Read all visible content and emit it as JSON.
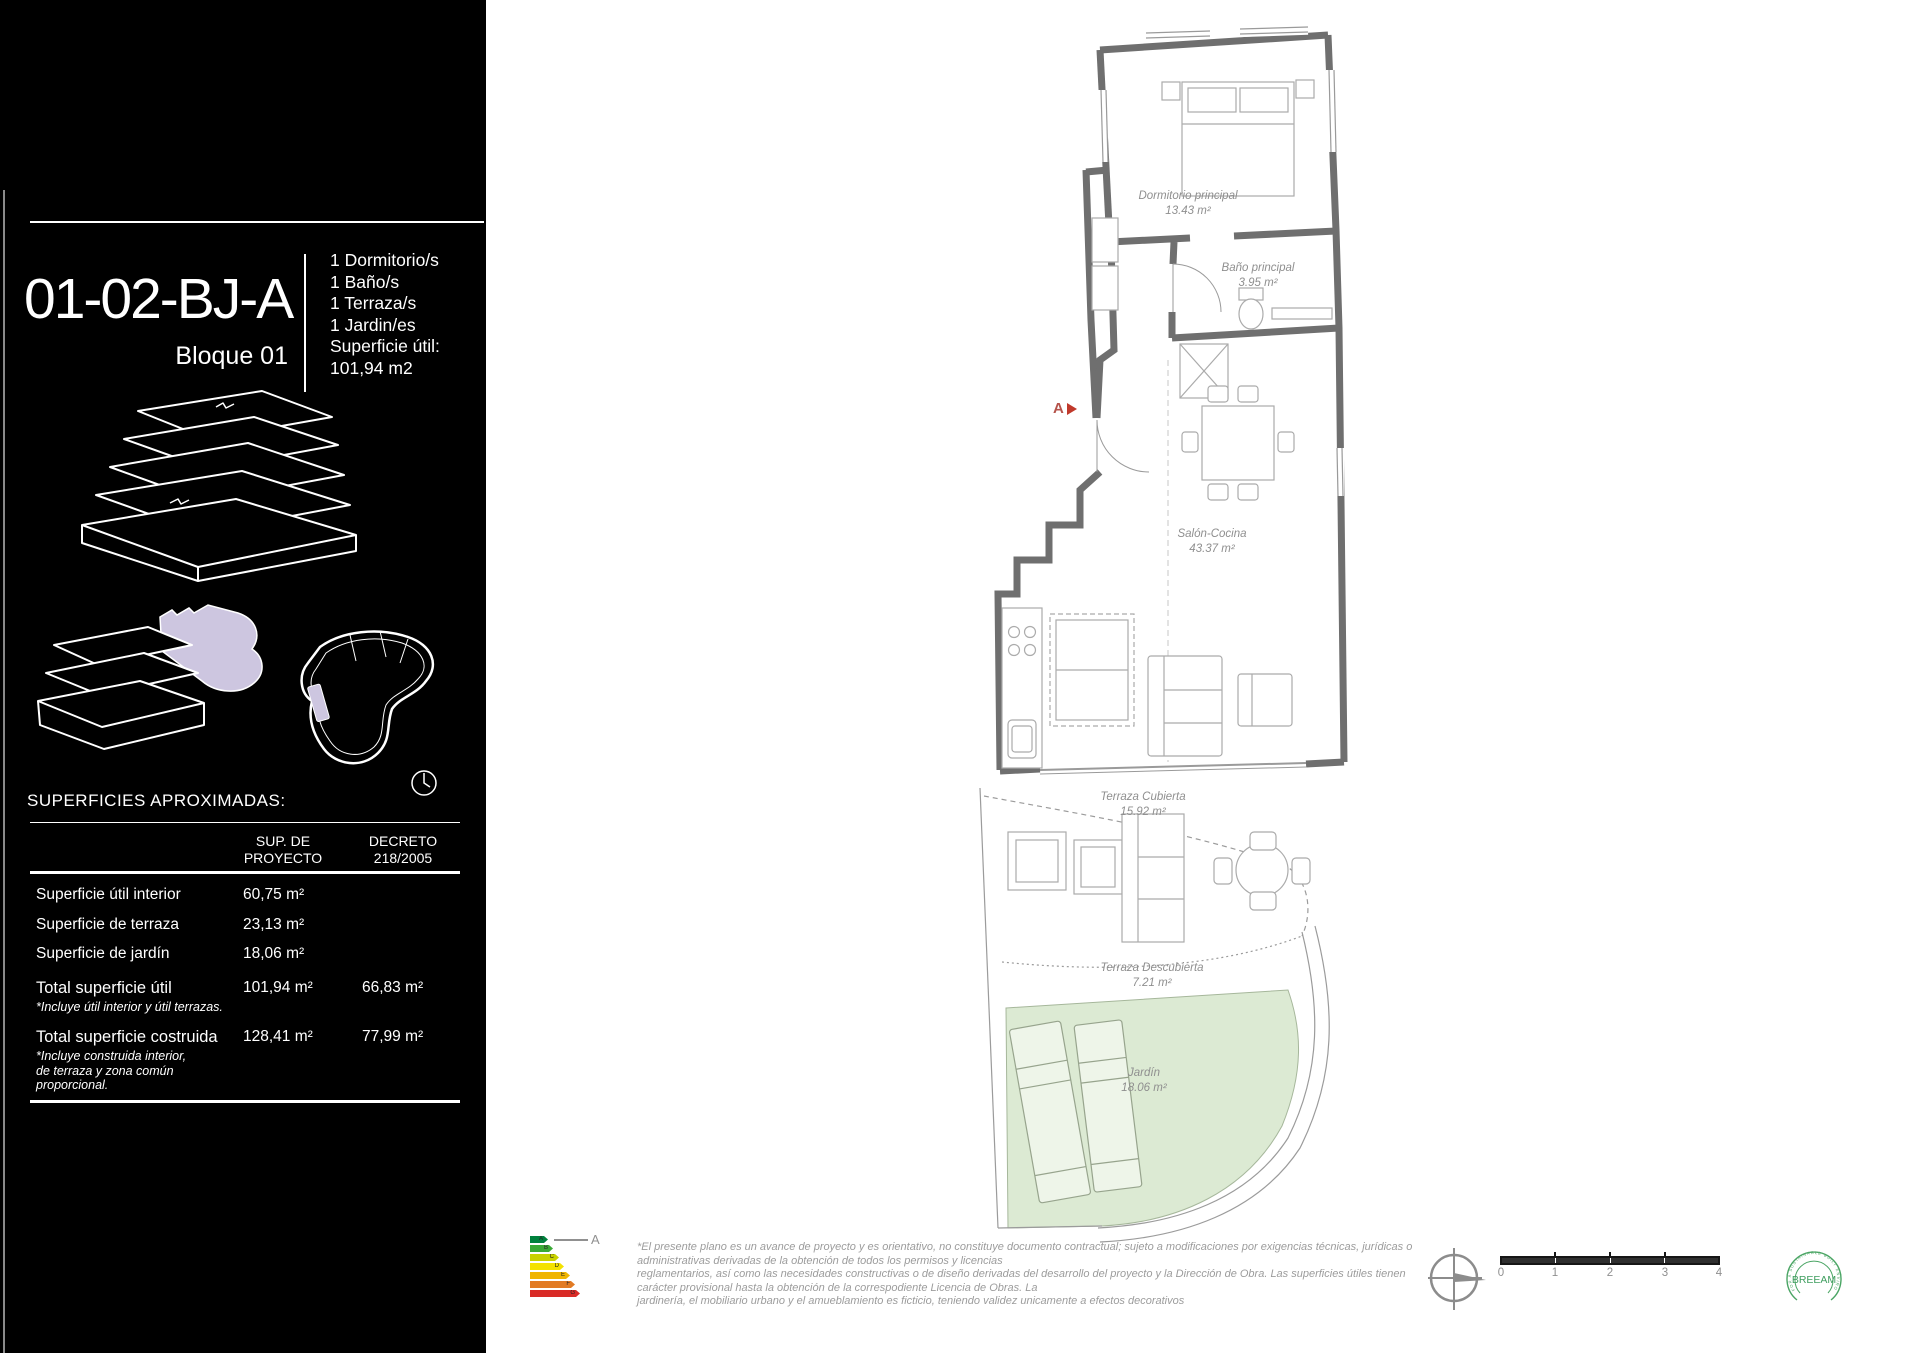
{
  "panel": {
    "unit_code": "01-02-BJ-A",
    "block_label": "Bloque 01",
    "features": [
      "1 Dormitorio/s",
      "1 Baño/s",
      "1 Terraza/s",
      "1 Jardin/es"
    ],
    "superficie_util_label": "Superficie útil:",
    "superficie_util_value": "101,94  m2",
    "surfaces_heading": "SUPERFICIES APROXIMADAS:",
    "table": {
      "col_proyecto": "SUP. DE\nPROYECTO",
      "col_decreto": "DECRETO\n218/2005",
      "rows": [
        {
          "label": "Superficie útil interior",
          "proyecto": "60,75  m²",
          "decreto": ""
        },
        {
          "label": "Superficie de terraza",
          "proyecto": "23,13  m²",
          "decreto": ""
        },
        {
          "label": "Superficie de jardín",
          "proyecto": "18,06 m²",
          "decreto": ""
        }
      ],
      "totals": [
        {
          "label": "Total superficie útil",
          "note": "*Incluye útil interior y útil terrazas.",
          "proyecto": "101,94  m²",
          "decreto": "66,83  m²"
        },
        {
          "label": "Total superficie costruida",
          "note": "*Incluye construida interior,\nde terraza y zona común\nproporcional.",
          "proyecto": "128,41  m²",
          "decreto": "77,99  m²"
        }
      ]
    }
  },
  "plan": {
    "section_marker": "A",
    "rooms": [
      {
        "name": "Dormitorio principal",
        "area": "13.43 m²"
      },
      {
        "name": "Baño principal",
        "area": "3.95 m²"
      },
      {
        "name": "Salón-Cocina",
        "area": "43.37 m²"
      },
      {
        "name": "Terraza Cubierta",
        "area": "15.92 m²"
      },
      {
        "name": "Terraza Descubierta",
        "area": "7.21 m²"
      },
      {
        "name": "Jardín",
        "area": "18.06 m²"
      }
    ],
    "colors": {
      "wall": "#6f6f6f",
      "furniture": "#ababab",
      "garden_fill": "#dcead3",
      "label_text": "#8f8f8f",
      "marker_red": "#c0392b",
      "unit_highlight": "#cdc6e0"
    }
  },
  "footer": {
    "disclaimer_lines": [
      "*El presente plano es un avance de proyecto y es orientativo, no constituye documento contractual; sujeto a modificaciones por exigencias técnicas, jurídicas o",
      "administrativas derivadas de la obtención de todos los permisos y licencias",
      "reglamentarios, así como las necesidades constructivas o de diseño derivadas del desarrollo del proyecto y la Dirección de Obra. Las superficies útiles tienen",
      "carácter provisional hasta la obtención de la correspodiente Licencia de Obras. La",
      "jardinería, el mobiliario urbano y el amueblamiento es ficticio, teniendo validez unicamente a efectos decorativos"
    ],
    "energy_label": {
      "letters": [
        "A",
        "B",
        "C",
        "D",
        "E",
        "F",
        "G"
      ],
      "colors": [
        "#00813d",
        "#39a935",
        "#c8d100",
        "#f4e200",
        "#f0b500",
        "#e27b24",
        "#d92b27"
      ],
      "indicator_letter": "A"
    },
    "scale_ticks": [
      "0",
      "1",
      "2",
      "3",
      "4"
    ],
    "breeam": {
      "name": "BREEAM",
      "ring_text": "FOR A SUSTAINABLE BUILT ENVIRONMENT"
    }
  }
}
